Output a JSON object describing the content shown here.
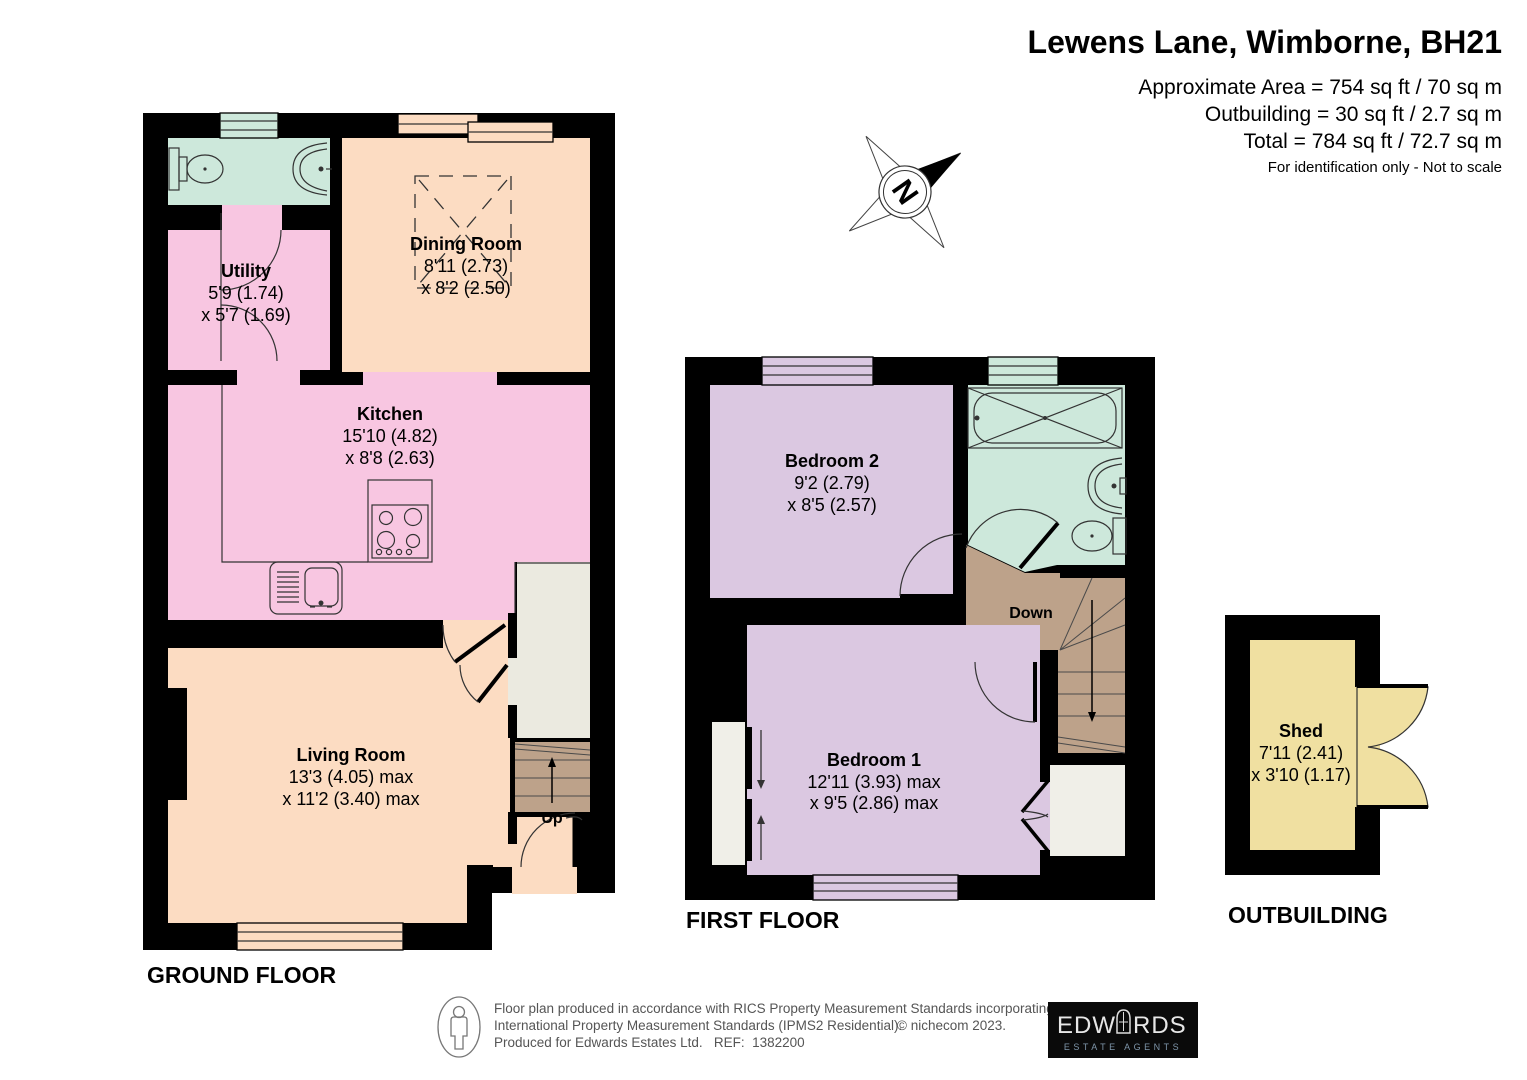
{
  "header": {
    "title": "Lewens Lane, Wimborne, BH21",
    "area_line1": "Approximate Area = 754 sq ft / 70 sq m",
    "area_line2": "Outbuilding = 30 sq ft / 2.7 sq m",
    "area_line3": "Total = 784 sq ft / 72.7 sq m",
    "note": "For identification only - Not to scale"
  },
  "compass": {
    "north_label": "N"
  },
  "ground_floor": {
    "label": "GROUND FLOOR",
    "stairs_label": "Up",
    "rooms": {
      "utility": {
        "name": "Utility",
        "dim1": "5'9 (1.74)",
        "dim2": "x 5'7 (1.69)"
      },
      "dining_room": {
        "name": "Dining Room",
        "dim1": "8'11 (2.73)",
        "dim2": "x 8'2 (2.50)"
      },
      "kitchen": {
        "name": "Kitchen",
        "dim1": "15'10 (4.82)",
        "dim2": "x 8'8 (2.63)"
      },
      "living_room": {
        "name": "Living Room",
        "dim1": "13'3 (4.05) max",
        "dim2": "x 11'2 (3.40) max"
      }
    }
  },
  "first_floor": {
    "label": "FIRST FLOOR",
    "stairs_label": "Down",
    "rooms": {
      "bedroom_2": {
        "name": "Bedroom 2",
        "dim1": "9'2 (2.79)",
        "dim2": "x 8'5 (2.57)"
      },
      "bedroom_1": {
        "name": "Bedroom 1",
        "dim1": "12'11 (3.93) max",
        "dim2": "x 9'5 (2.86) max"
      }
    }
  },
  "outbuilding": {
    "label": "OUTBUILDING",
    "rooms": {
      "shed": {
        "name": "Shed",
        "dim1": "7'11 (2.41)",
        "dim2": "x 3'10 (1.17)"
      }
    }
  },
  "footer": {
    "disclaimer_line1": "Floor plan produced in accordance with RICS Property Measurement Standards incorporating",
    "disclaimer_line2": "International Property Measurement Standards (IPMS2 Residential).",
    "copyright": "© nichecom 2023.",
    "disclaimer_line3": "Produced for Edwards Estates Ltd.   REF:  1382200",
    "logo": {
      "name_left": "EDW",
      "name_right": "RDS",
      "subtitle": "ESTATE AGENTS"
    }
  },
  "colors": {
    "wall": "#000000",
    "kitchen_pink": "#F8C6E1",
    "living_peach": "#FCDCC2",
    "bathroom_mint": "#CDE8DB",
    "bedroom_lilac": "#DBC8E1",
    "stairs_brown": "#BDA28A",
    "shed_yellow": "#F0E0A1",
    "cupboard_grey": "#EBEAE0",
    "closet_white": "#F0EFE8"
  }
}
